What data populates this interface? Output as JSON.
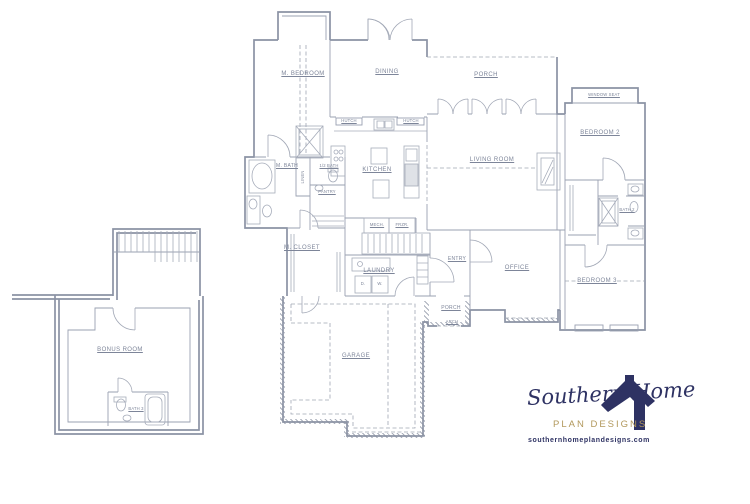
{
  "plan": {
    "labels": {
      "m_bedroom": "M. BEDROOM",
      "dining": "DINING",
      "porch_rear": "PORCH",
      "living_room": "LIVING ROOM",
      "window_seat": "WINDOW SEAT",
      "bedroom_2": "BEDROOM 2",
      "bath_2": "BATH 2",
      "bedroom_3": "BEDROOM 3",
      "office": "OFFICE",
      "entry": "ENTRY",
      "porch_front": "PORCH",
      "arch": "ARCH",
      "laundry": "LAUNDRY",
      "m_closet": "M. CLOSET",
      "m_bath": "M. BATH",
      "half_bath": "1/2 BATH",
      "pantry": "PANTRY",
      "kitchen": "KITCHEN",
      "garage": "GARAGE",
      "bonus_room": "BONUS ROOM",
      "bath_3": "BATH 3",
      "mech": "MECH.",
      "frzr": "FRZR.",
      "hutch_left": "HUTCH",
      "hutch_right": "HUTCH",
      "dryer": "D.",
      "washer": "W.",
      "linen": "LINEN"
    }
  },
  "logo": {
    "name": "Southern Home",
    "subtitle": "PLAN DESIGNS",
    "website": "southernhomeplandesigns.com"
  },
  "icons": {
    "logo_house": "house-icon"
  },
  "colors": {
    "plan_line": "#8B92A4",
    "navy": "#2E3263",
    "gold": "#B2985C"
  }
}
